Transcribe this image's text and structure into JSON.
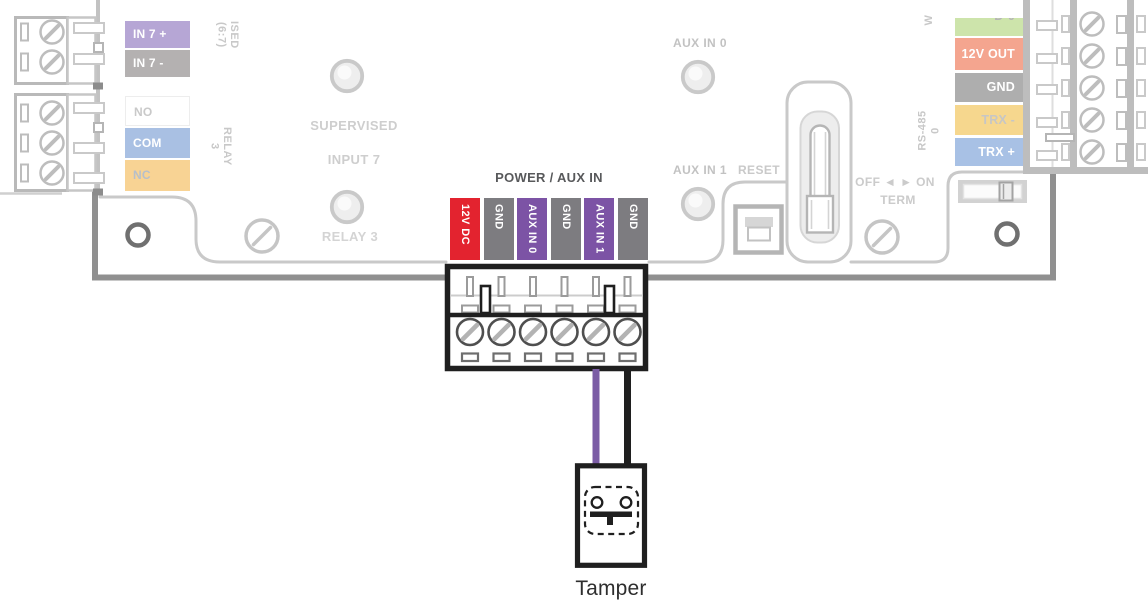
{
  "power_aux": {
    "title": "POWER / AUX IN",
    "terminals": [
      {
        "label": "12V DC",
        "bg": "#e3232f"
      },
      {
        "label": "GND",
        "bg": "#7d7c80"
      },
      {
        "label": "AUX IN 0",
        "bg": "#7c53a5"
      },
      {
        "label": "GND",
        "bg": "#7d7c80"
      },
      {
        "label": "AUX IN 1",
        "bg": "#7c53a5"
      },
      {
        "label": "GND",
        "bg": "#7d7c80"
      }
    ]
  },
  "left_side": {
    "vertical_top_lines": {
      "line1": "ISED",
      "line2": "(6:7)"
    },
    "input_labels": [
      {
        "label": "IN 7 +",
        "bg": "#b6a6d5",
        "fg": "#ffffff"
      },
      {
        "label": "IN 7 -",
        "bg": "#b4b1b1",
        "fg": "#ffffff"
      }
    ],
    "vertical_relay_lines": {
      "line1": "RELAY",
      "line2": "3"
    },
    "relay_labels": [
      {
        "label": "NO",
        "bg": "#ffffff",
        "fg": "#c9c9c9"
      },
      {
        "label": "COM",
        "bg": "#a9c0e3",
        "fg": "#ffffff"
      },
      {
        "label": "NC",
        "bg": "#f8d394",
        "fg": "#b7bfca"
      }
    ],
    "supervised_line1": "SUPERVISED",
    "supervised_line2": "INPUT 7",
    "relay_led_label": "RELAY 3"
  },
  "middle": {
    "aux_in_0": "AUX IN 0",
    "aux_in_1": "AUX IN 1",
    "reset": "RESET",
    "term_switch": "OFF ◄ ► ON",
    "term": "TERM"
  },
  "right_side": {
    "vertical_w": "W",
    "vertical_rs485": "RS-485",
    "vertical_rs485_line2": "0",
    "labels": [
      {
        "label": "D-0",
        "bg": "#cde4ab",
        "fg": "#b5b5b5"
      },
      {
        "label": "12V OUT",
        "bg": "#f4a58f",
        "fg": "#ffffff"
      },
      {
        "label": "GND",
        "bg": "#aeaeae",
        "fg": "#ffffff"
      },
      {
        "label": "TRX -",
        "bg": "#f6d78e",
        "fg": "#c6c6c6"
      },
      {
        "label": "TRX +",
        "bg": "#a8c1e5",
        "fg": "#ffffff"
      }
    ]
  },
  "tamper": {
    "label": "Tamper",
    "wires": [
      {
        "name": "aux-in-1-wire",
        "color": "#7b5ca5"
      },
      {
        "name": "gnd-wire",
        "color": "#1f1f1f"
      }
    ],
    "highlight_color": "#1f1f1f"
  }
}
